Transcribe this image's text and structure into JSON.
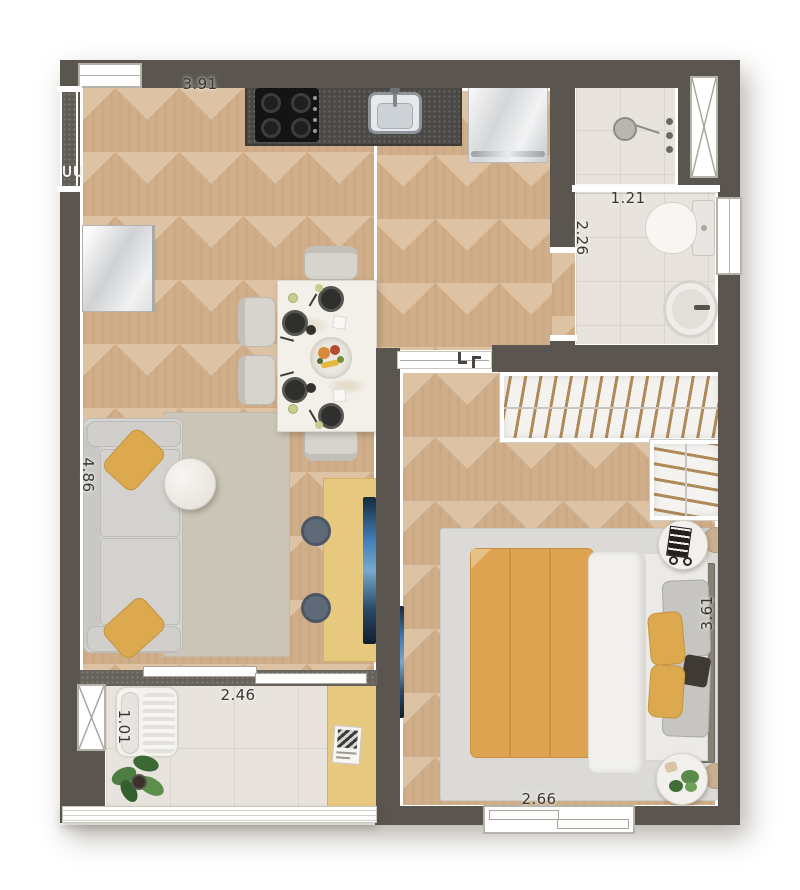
{
  "plan": {
    "dimensions": {
      "top_width": "3.91",
      "bath_width": "1.21",
      "bath_depth": "2.26",
      "living_depth": "4.86",
      "balcony_width": "2.46",
      "balcony_depth": "1.01",
      "bedroom_depth": "3.61",
      "bedroom_width": "2.66"
    },
    "colors": {
      "wall": "#5a554e",
      "wood_floor": "#cfae89",
      "tile_floor": "#e8e4dd",
      "counter_granite": "#4a4946",
      "accent_yellow": "#dfa452",
      "desk_yellow": "#e6c87e",
      "sofa_gray": "#d6d5d1",
      "tv_blue": "#4a7fae",
      "plant_green": "#4e7d42"
    }
  }
}
